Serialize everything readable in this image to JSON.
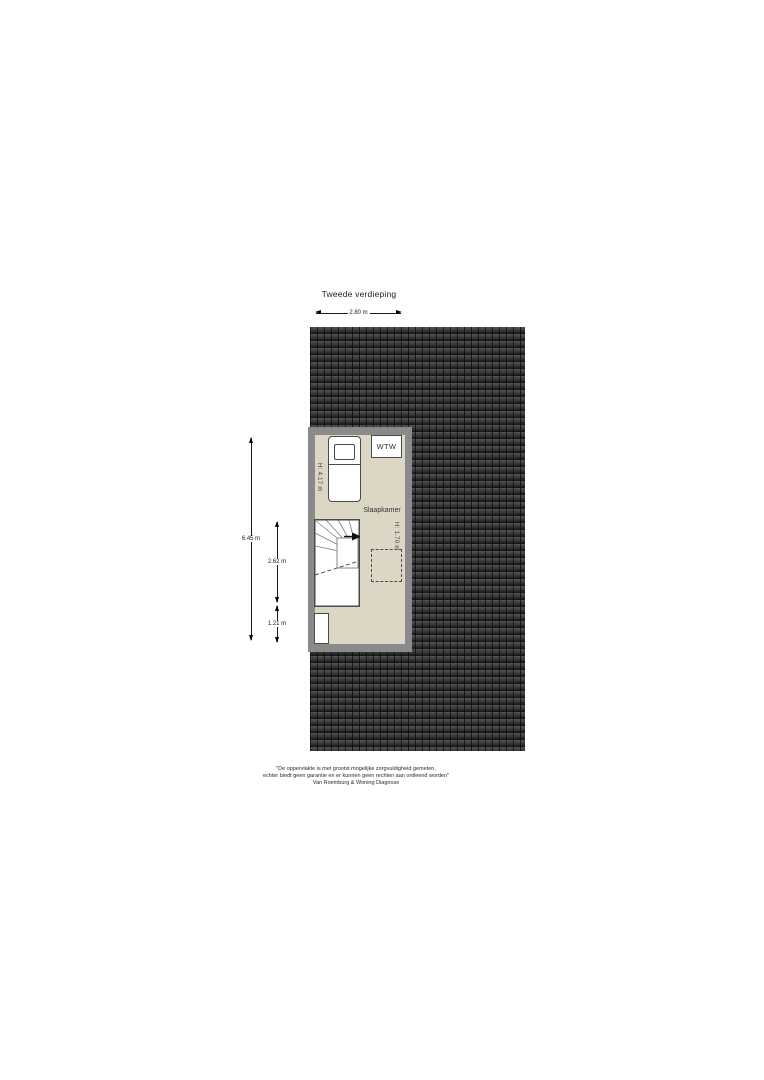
{
  "title": "Tweede verdieping",
  "dimensions": {
    "width_top": "2.80 m",
    "depth_total": "6.45 m",
    "depth_middle": "2.62 m",
    "depth_bottom": "1.21 m"
  },
  "room": {
    "name": "Slaapkamer",
    "ceiling_height_left": "H: 4.17 m",
    "ceiling_height_right": "H: 1.70 m",
    "wtw_unit": "WTW"
  },
  "disclaimer": {
    "line1": "\"De oppervlakte is met grootst mogelijke zorgvuldigheid gemeten,",
    "line2": "echter biedt geen garantie en er kunnen geen rechten aan ontleend worden\"",
    "line3": "Van Roemburg & Woning Diagnose"
  },
  "colors": {
    "roof": "#262626",
    "wall": "#8a8a8a",
    "floor": "#dcd6c4",
    "furniture_outline": "#4a4a4a",
    "dimension_line": "#1a1a1a"
  }
}
